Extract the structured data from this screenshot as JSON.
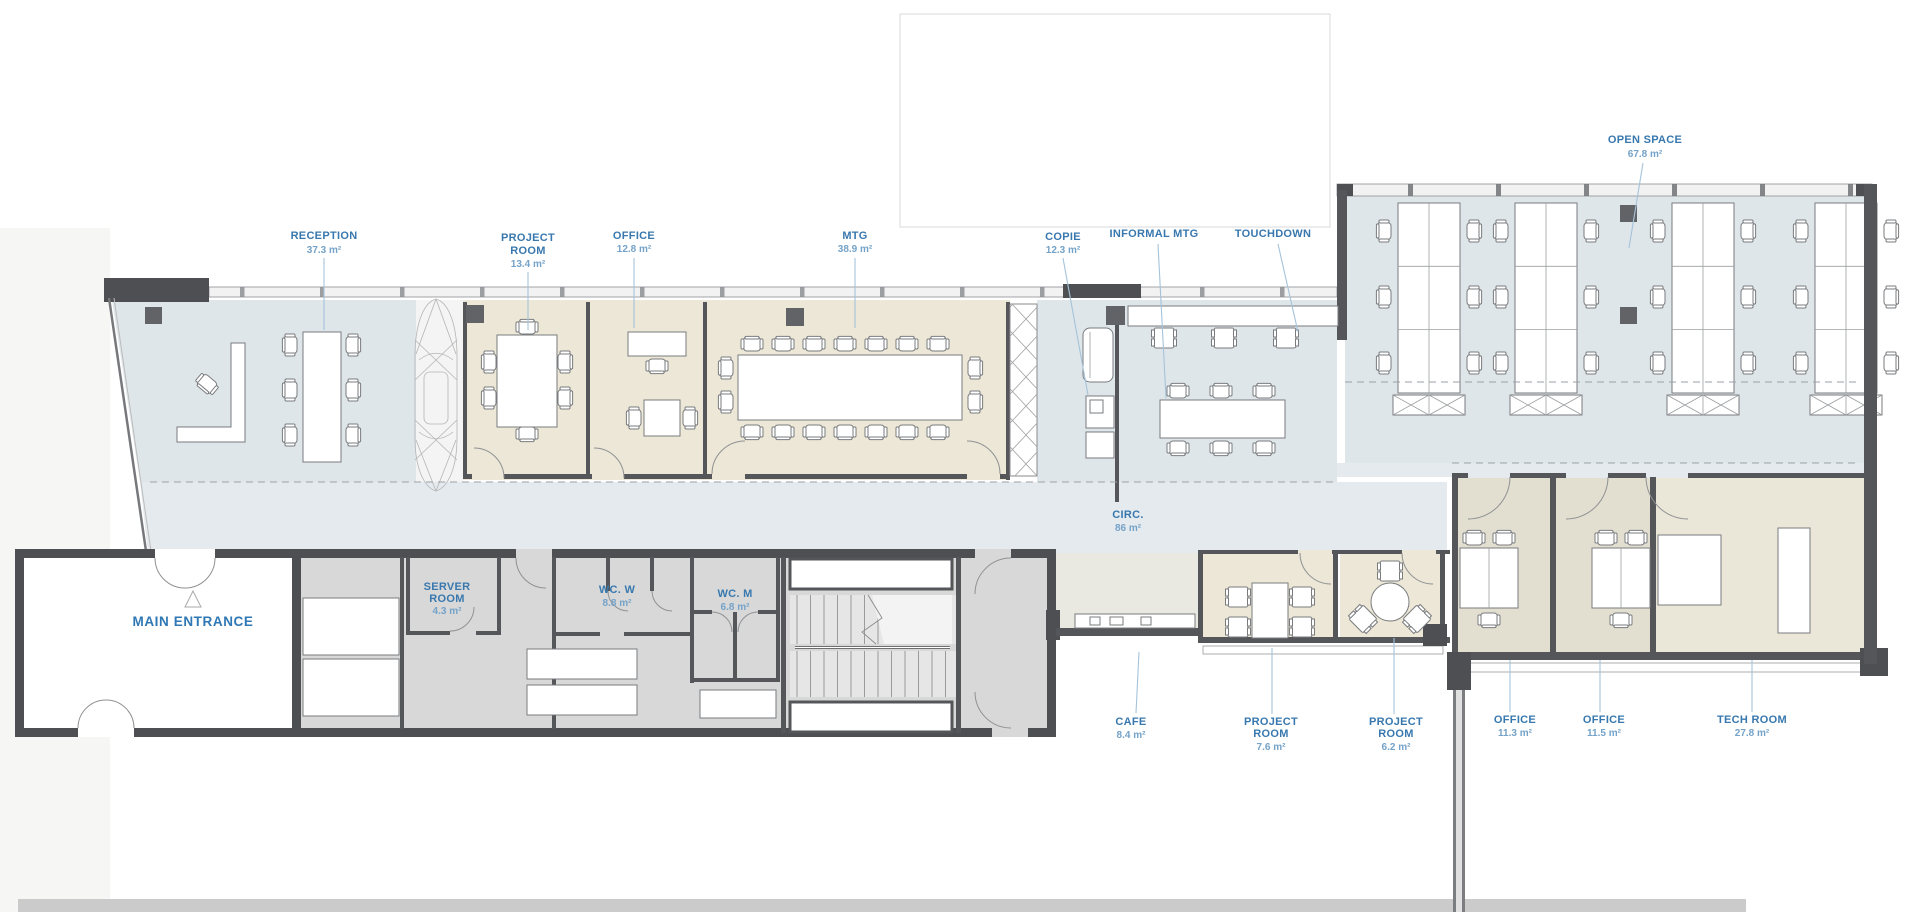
{
  "plan": {
    "labels": {
      "reception": {
        "lines": [
          "RECEPTION"
        ],
        "area": "37.3 m²"
      },
      "project_room_a": {
        "lines": [
          "PROJECT",
          "ROOM"
        ],
        "area": "13.4 m²"
      },
      "office_a": {
        "lines": [
          "OFFICE"
        ],
        "area": "12.8 m²"
      },
      "mtg": {
        "lines": [
          "MTG"
        ],
        "area": "38.9 m²"
      },
      "copie": {
        "lines": [
          "COPIE"
        ],
        "area": "12.3 m²"
      },
      "informal_mtg": {
        "lines": [
          "INFORMAL MTG"
        ],
        "area": ""
      },
      "touchdown": {
        "lines": [
          "TOUCHDOWN"
        ],
        "area": ""
      },
      "open_space": {
        "lines": [
          "OPEN SPACE"
        ],
        "area": "67.8 m²"
      },
      "circ": {
        "lines": [
          "CIRC."
        ],
        "area": "86 m²"
      },
      "main_entrance": {
        "lines": [
          "MAIN ENTRANCE"
        ],
        "area": ""
      },
      "server_room": {
        "lines": [
          "SERVER",
          "ROOM"
        ],
        "area": "4.3 m²"
      },
      "wc_w": {
        "lines": [
          "WC. W"
        ],
        "area": "8.8 m²"
      },
      "wc_m": {
        "lines": [
          "WC. M"
        ],
        "area": "6.8 m²"
      },
      "cafe": {
        "lines": [
          "CAFE"
        ],
        "area": "8.4 m²"
      },
      "project_room_b": {
        "lines": [
          "PROJECT",
          "ROOM"
        ],
        "area": "7.6 m²"
      },
      "project_room_c": {
        "lines": [
          "PROJECT",
          "ROOM"
        ],
        "area": "6.2 m²"
      },
      "office_b": {
        "lines": [
          "OFFICE"
        ],
        "area": "11.3 m²"
      },
      "office_c": {
        "lines": [
          "OFFICE"
        ],
        "area": "11.5 m²"
      },
      "tech_room": {
        "lines": [
          "TECH ROOM"
        ],
        "area": "27.8 m²"
      }
    },
    "colors": {
      "label_blue": "#3878ae",
      "area_blue": "#74a2c8",
      "room_blue": "#dfe6ea",
      "room_beige": "#ece7d6",
      "wall_gray": "#55565a",
      "service_gray": "#d8d8d8"
    }
  }
}
